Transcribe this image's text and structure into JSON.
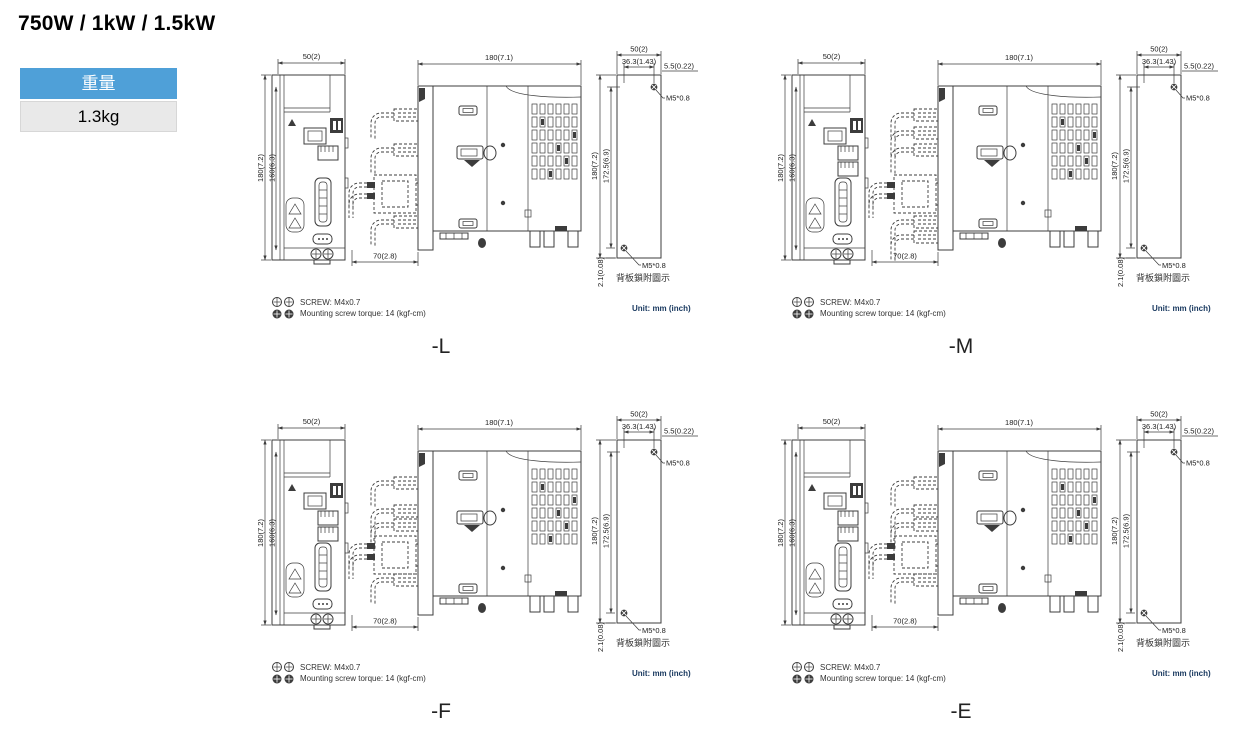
{
  "page": {
    "title": "750W / 1kW / 1.5kW"
  },
  "weight_table": {
    "header": "重量",
    "value": "1.3kg"
  },
  "colors": {
    "accent_blue": "#4FA0D8",
    "table_value_bg": "#E9E9E9",
    "unit_text": "#17375E",
    "drawing_line": "#3C3C3C"
  },
  "quadrants": [
    {
      "label": "-L",
      "front_dims": {
        "width": "50(2)",
        "height": "180(7.2)",
        "inner_height": "160(6.3)"
      },
      "side_dims": {
        "depth": "180(7.1)",
        "connector_depth": "70(2.8)"
      },
      "rear_dims": {
        "width": "50(2)",
        "screw_span": "36.3(1.43)",
        "screw_edge_offset": "5.5(0.22)",
        "height": "180(7.2)",
        "screw_height": "172.5(6.9)",
        "bottom_offset": "2.1(0.08)"
      },
      "rear_labels": {
        "screw_top": "M5*0.8",
        "screw_bottom": "M5*0.8",
        "caption": "背板鎖附圖示"
      },
      "notes": {
        "screw_spec": "SCREW: M4x0.7",
        "torque": "Mounting screw torque: 14 (kgf-cm)",
        "unit": "Unit: mm (inch)"
      }
    },
    {
      "label": "-M",
      "front_dims": {
        "width": "50(2)",
        "height": "180(7.2)",
        "inner_height": "160(6.3)"
      },
      "side_dims": {
        "depth": "180(7.1)",
        "connector_depth": "70(2.8)"
      },
      "rear_dims": {
        "width": "50(2)",
        "screw_span": "36.3(1.43)",
        "screw_edge_offset": "5.5(0.22)",
        "height": "180(7.2)",
        "screw_height": "172.5(6.9)",
        "bottom_offset": "2.1(0.08)"
      },
      "rear_labels": {
        "screw_top": "M5*0.8",
        "screw_bottom": "M5*0.8",
        "caption": "背板鎖附圖示"
      },
      "notes": {
        "screw_spec": "SCREW: M4x0.7",
        "torque": "Mounting screw torque: 14 (kgf-cm)",
        "unit": "Unit: mm (inch)"
      }
    },
    {
      "label": "-F",
      "front_dims": {
        "width": "50(2)",
        "height": "180(7.2)",
        "inner_height": "160(6.3)"
      },
      "side_dims": {
        "depth": "180(7.1)",
        "connector_depth": "70(2.8)"
      },
      "rear_dims": {
        "width": "50(2)",
        "screw_span": "36.3(1.43)",
        "screw_edge_offset": "5.5(0.22)",
        "height": "180(7.2)",
        "screw_height": "172.5(6.9)",
        "bottom_offset": "2.1(0.08)"
      },
      "rear_labels": {
        "screw_top": "M5*0.8",
        "screw_bottom": "M5*0.8",
        "caption": "背板鎖附圖示"
      },
      "notes": {
        "screw_spec": "SCREW: M4x0.7",
        "torque": "Mounting screw torque: 14 (kgf-cm)",
        "unit": "Unit: mm (inch)"
      }
    },
    {
      "label": "-E",
      "front_dims": {
        "width": "50(2)",
        "height": "180(7.2)",
        "inner_height": "160(6.3)"
      },
      "side_dims": {
        "depth": "180(7.1)",
        "connector_depth": "70(2.8)"
      },
      "rear_dims": {
        "width": "50(2)",
        "screw_span": "36.3(1.43)",
        "screw_edge_offset": "5.5(0.22)",
        "height": "180(7.2)",
        "screw_height": "172.5(6.9)",
        "bottom_offset": "2.1(0.08)"
      },
      "rear_labels": {
        "screw_top": "M5*0.8",
        "screw_bottom": "M5*0.8",
        "caption": "背板鎖附圖示"
      },
      "notes": {
        "screw_spec": "SCREW: M4x0.7",
        "torque": "Mounting screw torque: 14 (kgf-cm)",
        "unit": "Unit: mm (inch)"
      }
    }
  ]
}
